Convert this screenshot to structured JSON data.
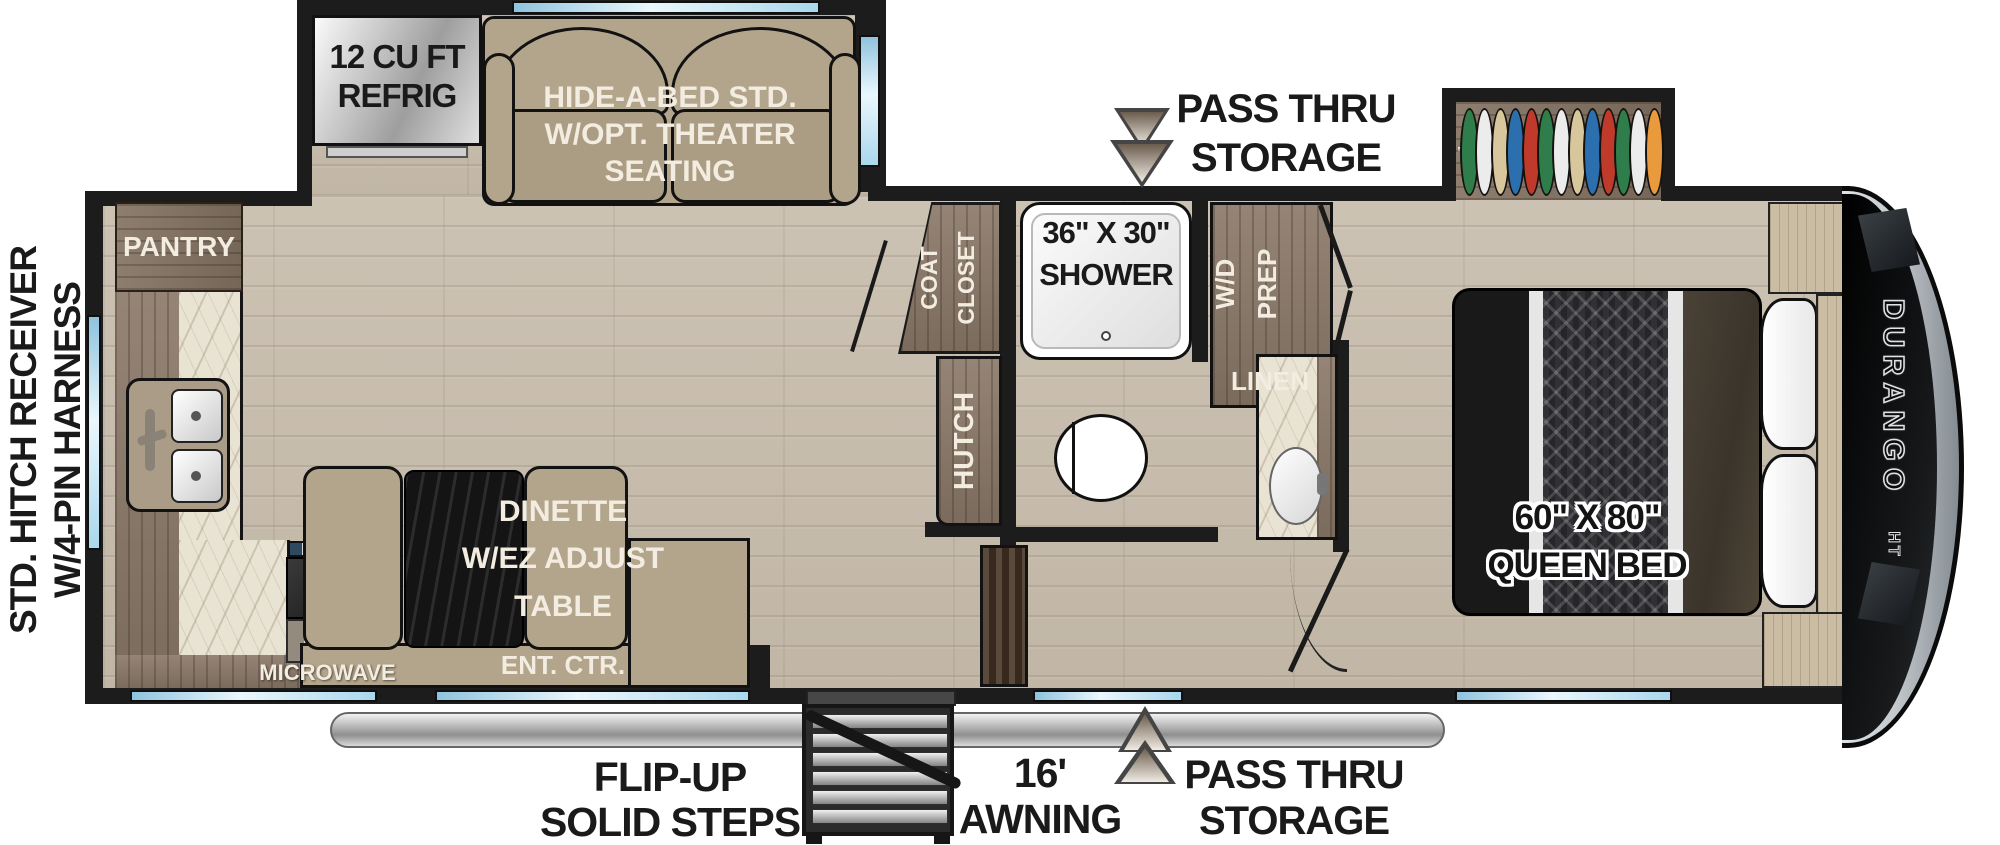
{
  "exterior": {
    "hitch_label": {
      "line1": "STD. HITCH RECEIVER",
      "line2": "W/4-PIN HARNESS"
    },
    "pass_thru_top": {
      "line1": "PASS THRU",
      "line2": "STORAGE"
    },
    "pass_thru_bottom": {
      "line1": "PASS THRU",
      "line2": "STORAGE"
    },
    "awning": {
      "line1": "16'",
      "line2": "AWNING"
    },
    "steps": {
      "line1": "FLIP-UP",
      "line2": "SOLID STEPS"
    },
    "brand": "DURANGO",
    "brand_sub": "HT"
  },
  "kitchen": {
    "refrig": {
      "line1": "12 CU FT",
      "line2": "REFRIG"
    },
    "pantry": "PANTRY",
    "microwave": "MICROWAVE"
  },
  "living": {
    "sofa": {
      "line1": "HIDE-A-BED STD.",
      "line2": "W/OPT. THEATER",
      "line3": "SEATING"
    },
    "dinette": {
      "line1": "DINETTE",
      "line2": "W/EZ ADJUST",
      "line3": "TABLE"
    },
    "ent_ctr": "ENT. CTR."
  },
  "bath": {
    "coat_closet": {
      "line1": "COAT",
      "line2": "CLOSET"
    },
    "shower": {
      "line1": "36\" X 30\"",
      "line2": "SHOWER"
    },
    "wd_prep": {
      "line1": "W/D",
      "line2": "PREP"
    },
    "linen": "LINEN",
    "hutch": "HUTCH"
  },
  "bedroom": {
    "bed": {
      "line1": "60\" X 80\"",
      "line2": "QUEEN BED"
    },
    "hanger_colors": [
      "#2f7d4a",
      "#ececec",
      "#d8c79c",
      "#2b6fae",
      "#bf3a2b",
      "#2f7d4a",
      "#ececec",
      "#d8c79c",
      "#2b6fae",
      "#bf3a2b",
      "#2f7d4a",
      "#ececec",
      "#e89a3c"
    ]
  },
  "colors": {
    "wall": "#1c1c1c",
    "window_blue": "#9fd3ea",
    "floor_wood": "#c8beaf",
    "cabinet_wood": "#8c7a6a",
    "upholstery_tan": "#b3a58c",
    "counter_marble": "#e9e3d4",
    "label_white": "#f3ece0",
    "label_black": "#1a1a1a"
  }
}
